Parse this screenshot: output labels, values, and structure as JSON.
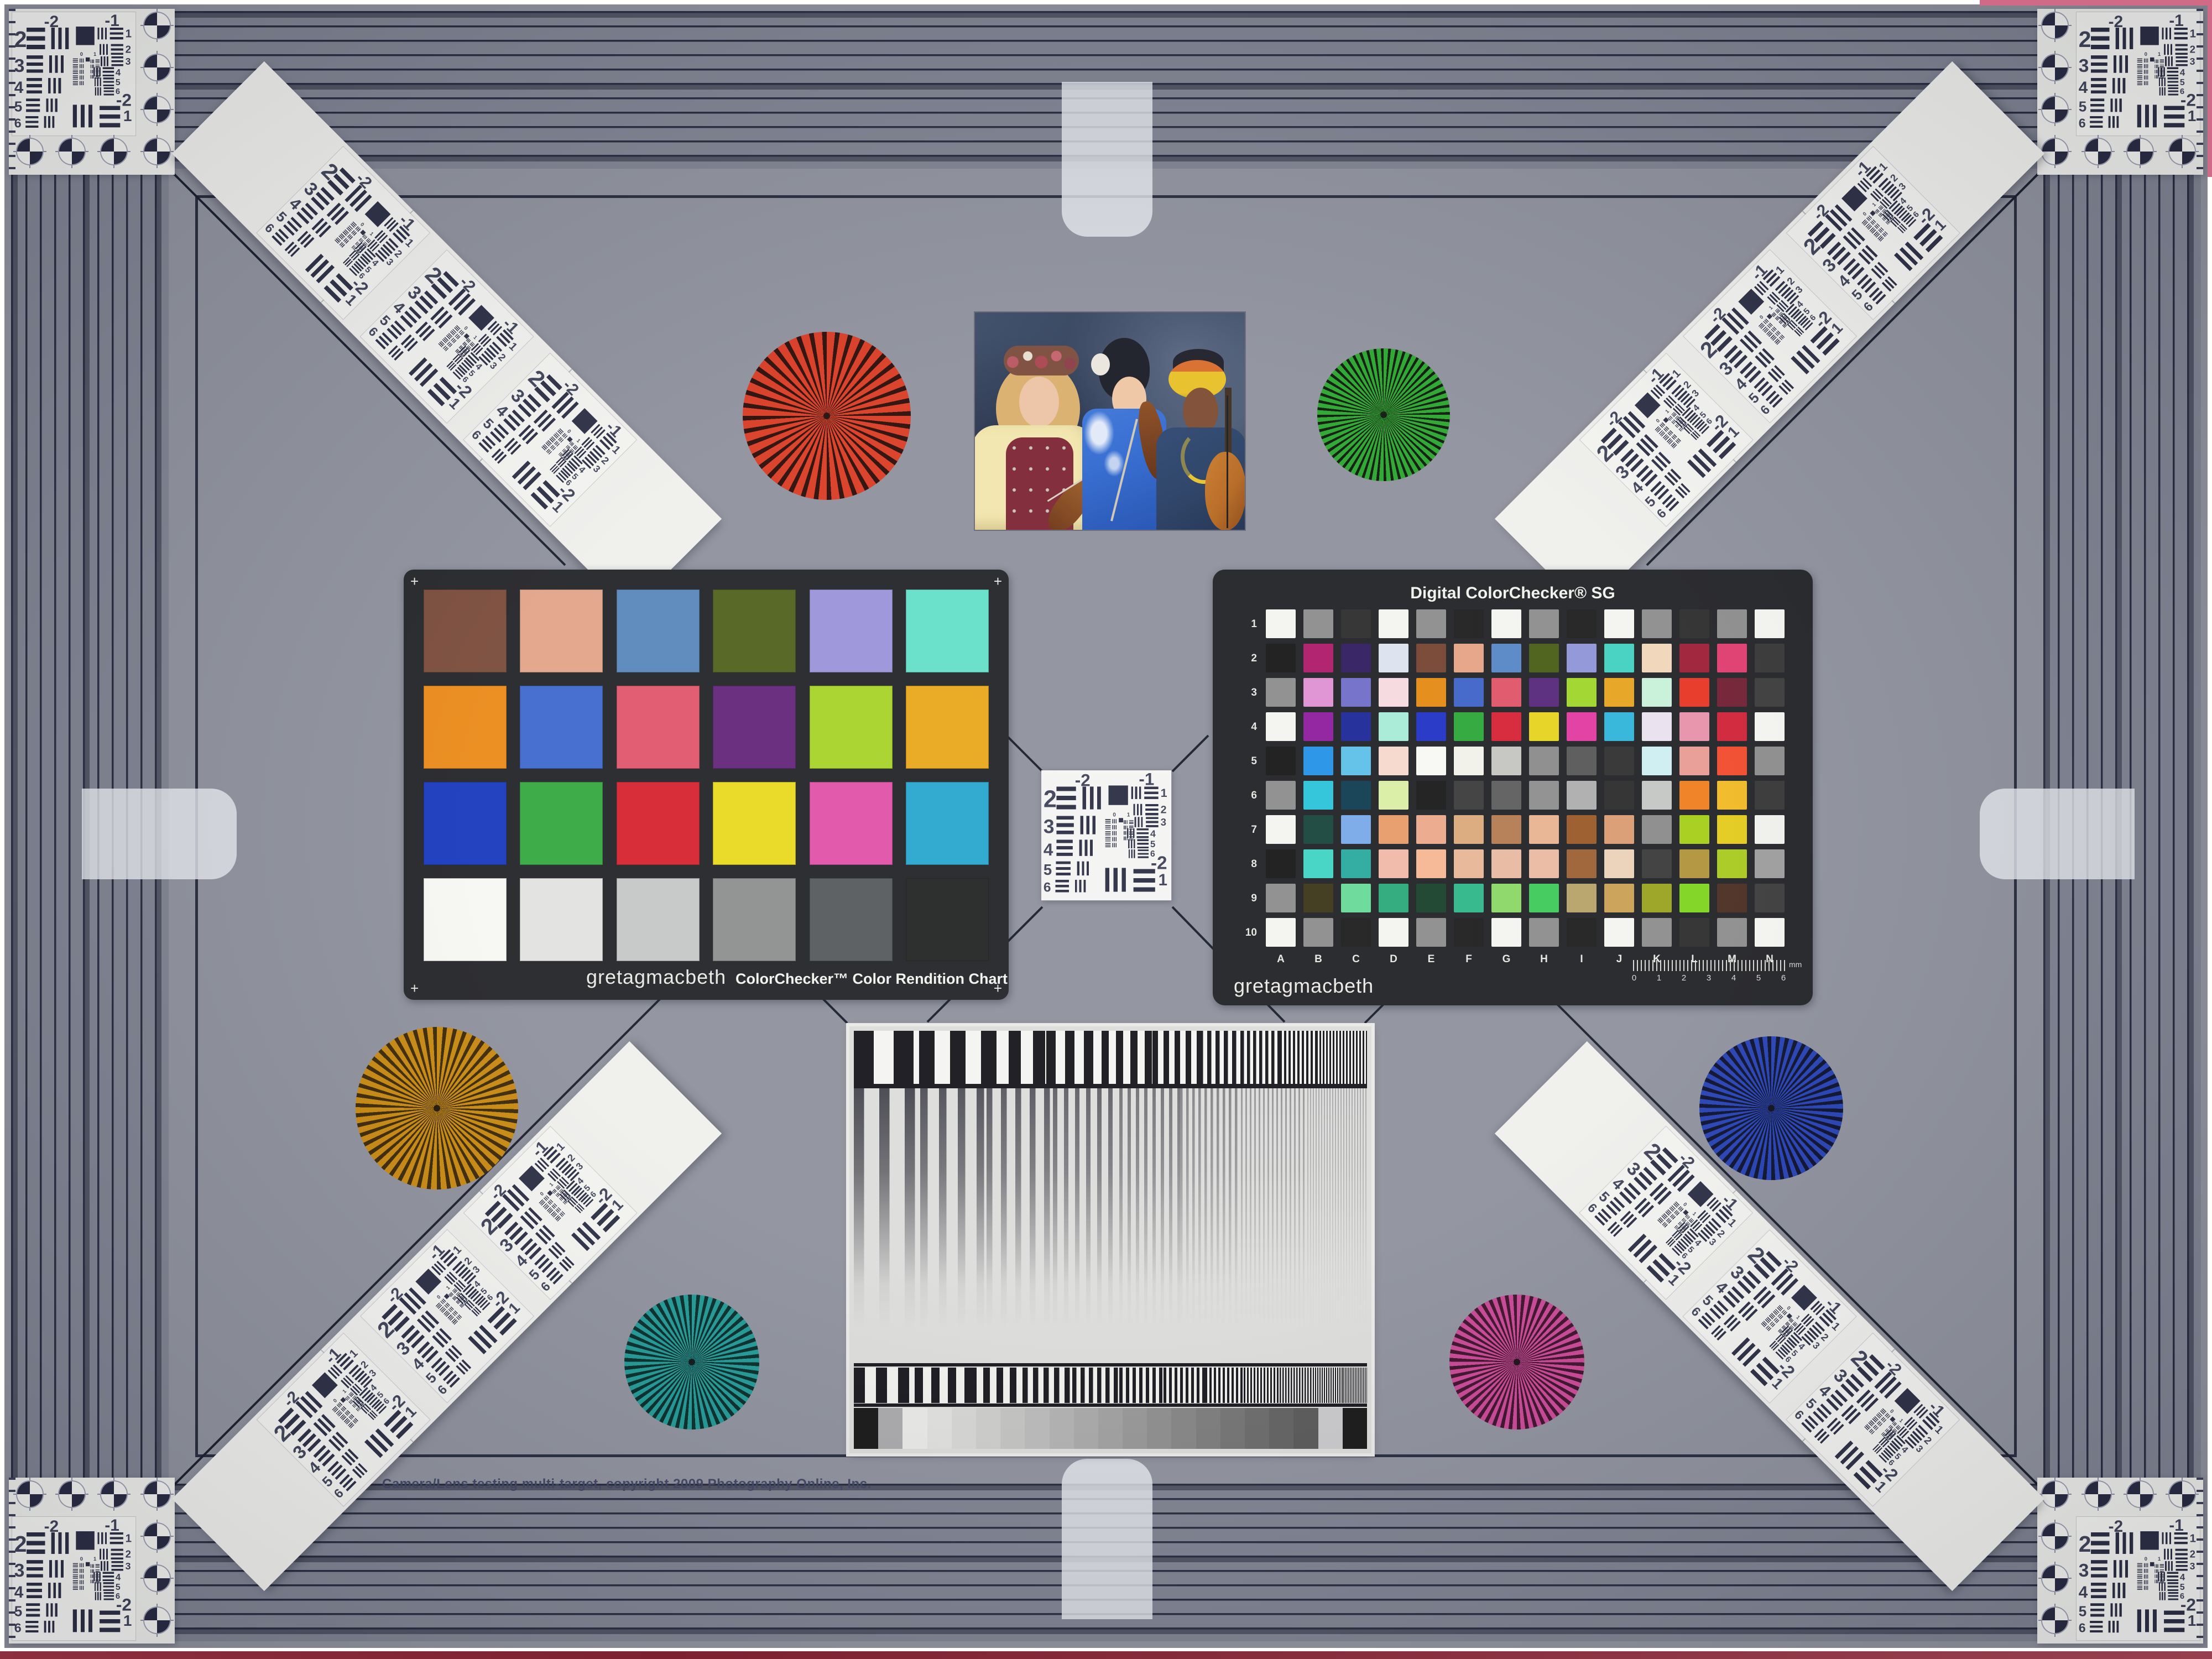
{
  "artifact": {
    "copyright": "Camera/Lens testing multi-target, copyright 2009 Photography Online, Inc."
  },
  "classic_chart": {
    "brand": "gretagmacbeth",
    "title": "ColorChecker™ Color Rendition Chart",
    "corner_mark": "+",
    "patch_colors": [
      "#7a4b3a",
      "#e2a488",
      "#5887bb",
      "#4f611d",
      "#9a93d8",
      "#63dfc8",
      "#eb8a18",
      "#3d68cf",
      "#e1566c",
      "#632578",
      "#a5d327",
      "#e9a71a",
      "#1839bd",
      "#34a93f",
      "#d62330",
      "#e9d81e",
      "#e051a8",
      "#28a5cd",
      "#f7f7f3",
      "#e2e2e0",
      "#c5c7c7",
      "#8d8f8e",
      "#565a5c",
      "#232424"
    ]
  },
  "sg_chart": {
    "title": "Digital ColorChecker® SG",
    "brand": "gretagmacbeth",
    "row_labels": [
      "1",
      "2",
      "3",
      "4",
      "5",
      "6",
      "7",
      "8",
      "9",
      "10"
    ],
    "col_labels": [
      "A",
      "B",
      "C",
      "D",
      "E",
      "F",
      "G",
      "H",
      "I",
      "J",
      "K",
      "L",
      "M",
      "N"
    ],
    "ruler_numbers": [
      "0",
      "1",
      "2",
      "3",
      "4",
      "5",
      "6"
    ],
    "ruler_unit": "mm",
    "patch_rows": [
      [
        "#f4f4f0",
        "#8c8c8c",
        "#2c2c2c",
        "#f4f4f0",
        "#8c8c8c",
        "#1d1d1d",
        "#f4f4f0",
        "#8c8c8c",
        "#1d1d1d",
        "#f4f4f0",
        "#8c8c8c",
        "#2c2c2c",
        "#8c8c8c",
        "#f4f4f0"
      ],
      [
        "#171717",
        "#ae1a69",
        "#2f1b5e",
        "#dbe3ee",
        "#75432f",
        "#e6a284",
        "#5686c5",
        "#485d15",
        "#8e94d7",
        "#40d0c0",
        "#f0d6b8",
        "#9d1d35",
        "#e03b6e",
        "#343434"
      ],
      [
        "#8c8c8c",
        "#de8fd2",
        "#706dc9",
        "#f6dade",
        "#e48913",
        "#3c63c7",
        "#df5367",
        "#55277a",
        "#9dd529",
        "#e6a21c",
        "#c7f1d9",
        "#e73423",
        "#701e31",
        "#3a3a3a"
      ],
      [
        "#f4f4f0",
        "#8d1d9d",
        "#1d2797",
        "#a6ebd5",
        "#1f32c5",
        "#2ba738",
        "#d52235",
        "#e6d41e",
        "#e339a1",
        "#2fb4d9",
        "#e9e0ee",
        "#e690a9",
        "#cf2136",
        "#f4f4f0"
      ],
      [
        "#171717",
        "#2491e7",
        "#5dc0e9",
        "#f6d8cd",
        "#f8f8f3",
        "#f1f0e9",
        "#c4c4c0",
        "#8a8a8a",
        "#565656",
        "#2f2f2f",
        "#cdeef2",
        "#e79b92",
        "#f1492a",
        "#8b8b8b"
      ],
      [
        "#8c8c8c",
        "#2bc3d9",
        "#0f3b4f",
        "#d9eea4",
        "#191919",
        "#3b3b3b",
        "#5d5d5d",
        "#8d8d8d",
        "#adadad",
        "#2b2b2b",
        "#c4c6c4",
        "#ef7d1c",
        "#f0b822",
        "#343434"
      ],
      [
        "#f4f4f0",
        "#16453b",
        "#78a9e9",
        "#e79b69",
        "#eaa889",
        "#d9a979",
        "#b37b51",
        "#e8b290",
        "#995927",
        "#d99b71",
        "#8a8a8a",
        "#a4ce17",
        "#e3ca1b",
        "#f0f0ec"
      ],
      [
        "#171717",
        "#3fd4c4",
        "#29a99d",
        "#f1b9a9",
        "#f6b692",
        "#e8b597",
        "#e8b9a0",
        "#eab9a1",
        "#9b6031",
        "#ebd1b9",
        "#3a3a3a",
        "#b09339",
        "#a8c91e",
        "#9c9c9c"
      ],
      [
        "#8c8c8c",
        "#3b3618",
        "#67d998",
        "#2aa979",
        "#164029",
        "#2db588",
        "#8ad764",
        "#3cc959",
        "#b5a267",
        "#c99f53",
        "#9aa21f",
        "#7ed41c",
        "#4a2c20",
        "#3a3a3a"
      ],
      [
        "#f4f4f0",
        "#8c8c8c",
        "#1d1d1d",
        "#f4f4f0",
        "#8c8c8c",
        "#1d1d1d",
        "#f4f4f0",
        "#8c8c8c",
        "#1d1d1d",
        "#f4f4f0",
        "#8c8c8c",
        "#2c2c2c",
        "#8c8c8c",
        "#f4f4f0"
      ]
    ]
  },
  "usaf": {
    "top_left_label": "-2",
    "top_right_label": "-1",
    "left_numbers": [
      "2",
      "3",
      "4",
      "5",
      "6"
    ],
    "right_numbers": [
      "1",
      "2",
      "3",
      "4",
      "5",
      "6"
    ],
    "bottom_labels": [
      "-2",
      "1"
    ],
    "micro_labels": [
      "0",
      "1"
    ]
  },
  "starbursts": [
    {
      "name": "red",
      "color": "#d93a22",
      "dark": "#2a0b06"
    },
    {
      "name": "green",
      "color": "#28a52c",
      "dark": "#0b1607"
    },
    {
      "name": "amber",
      "color": "#c8880e",
      "dark": "#3a2706"
    },
    {
      "name": "blue",
      "color": "#2440b4",
      "dark": "#0a0f2c"
    },
    {
      "name": "teal",
      "color": "#1f9894",
      "dark": "#062a28"
    },
    {
      "name": "magenta",
      "color": "#c84594",
      "dark": "#3c0f2a"
    }
  ],
  "gray_wedge": [
    "#151515",
    "#a9a9ab",
    "#e9e9e7",
    "#e0e0de",
    "#d6d6d4",
    "#cdcdcb",
    "#c3c3c1",
    "#bababa",
    "#b1b1b1",
    "#a8a8a8",
    "#9f9f9f",
    "#969696",
    "#8d8d8d",
    "#848484",
    "#7b7b7b",
    "#727272",
    "#696969",
    "#606060",
    "#575757",
    "#c9c9cc",
    "#151515"
  ],
  "frame_colors": {
    "background": "#8e919c",
    "band": "#7e8290",
    "line": "#262a3e",
    "corner_card": "#edeeea"
  },
  "photo_palette": {
    "backdrop": "#33415c",
    "blouse_yellow": "#f2e6ad",
    "vest_red": "#7e2433",
    "kimono_blue": "#2e68cf",
    "turban_yellow": "#e8bf25",
    "robe_blue": "#263d63",
    "violin_brown": "#8a4a1e",
    "cello_orange": "#b5671f"
  }
}
